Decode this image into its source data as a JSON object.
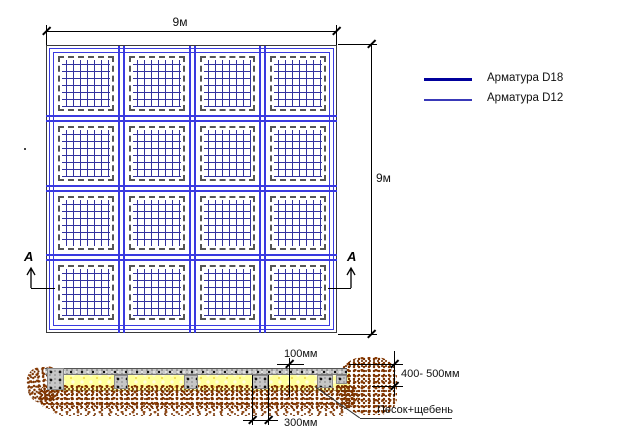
{
  "plan": {
    "dim_width_label": "9м",
    "dim_height_label": "9м",
    "section_mark_left": "А",
    "section_mark_right": "А"
  },
  "legend": {
    "items": [
      {
        "label": "Арматура D18",
        "color": "#00009c",
        "weight": "thick"
      },
      {
        "label": "Арматура D12",
        "color": "#3939b8",
        "weight": "thin"
      }
    ]
  },
  "section": {
    "dim_slab_thickness": "100мм",
    "dim_rib_width": "300мм",
    "dim_depth": "400- 500мм",
    "material_label": "Песок+щебень"
  },
  "colors": {
    "rebar_grid_blue": "#3a3ae0",
    "mesh_blue": "#32329f",
    "slab_gray": "#c6c6c6",
    "sand_yellow": "#ffff9c",
    "gravel_brown": "#8a3c05"
  }
}
